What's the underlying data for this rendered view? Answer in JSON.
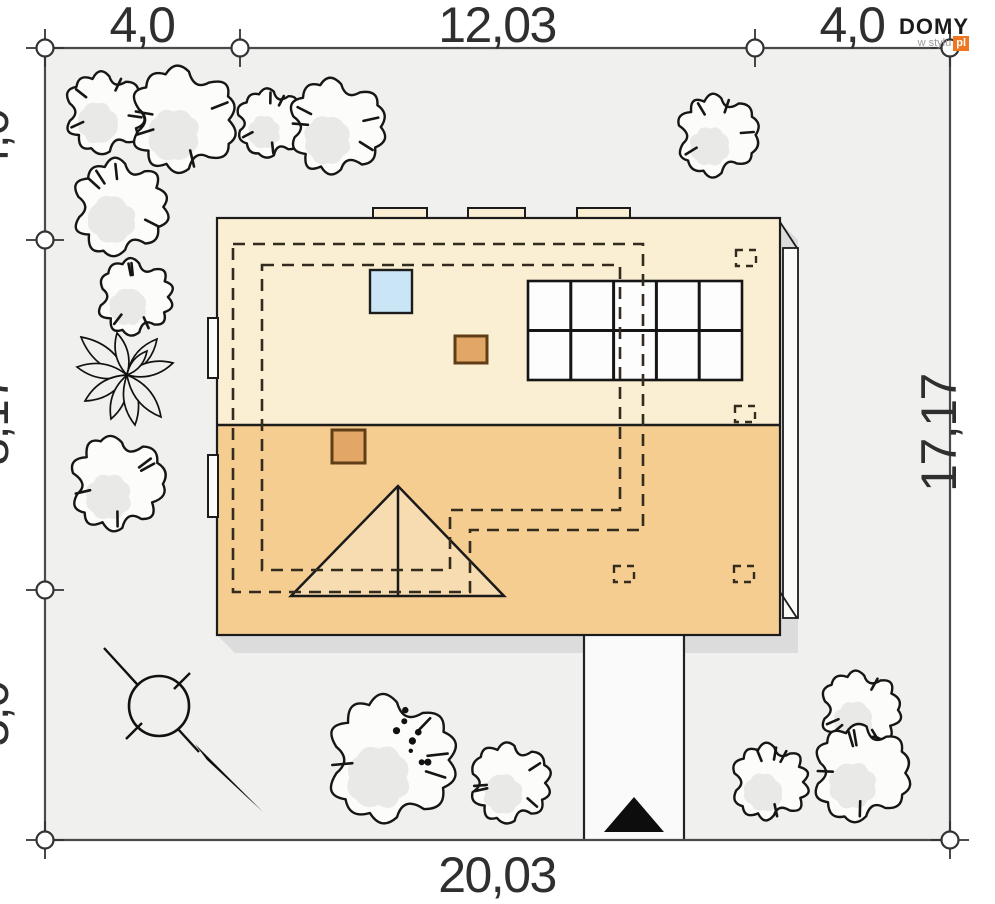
{
  "page": {
    "type": "architectural site plan (roof / plot view)"
  },
  "branding": {
    "title": "DOMY",
    "subtitle": "w stylu",
    "badge": "pl"
  },
  "dimensions": {
    "top": [
      "4,0",
      "12,03",
      "4,0"
    ],
    "left": [
      "4,0",
      "8,17",
      "5,0"
    ],
    "right_total": "17,17",
    "bottom_total": "20,03"
  },
  "colors": {
    "plot_background": "#f0f0ee",
    "roof_upper": "#faeed3",
    "roof_lower": "#f6cd90",
    "chimney": "#e2a766",
    "chimney_border": "#5f3d17",
    "skylight_blue": "#cae5f6",
    "shadow": "#dcdcdc",
    "outline": "#1c1c1c",
    "dashed_line": "#332b1d",
    "driveway": "#fafafa",
    "tree_fill": "#fcfcfa",
    "logo_orange": "#ee7622",
    "dimension_text": "#2f2f2f"
  }
}
